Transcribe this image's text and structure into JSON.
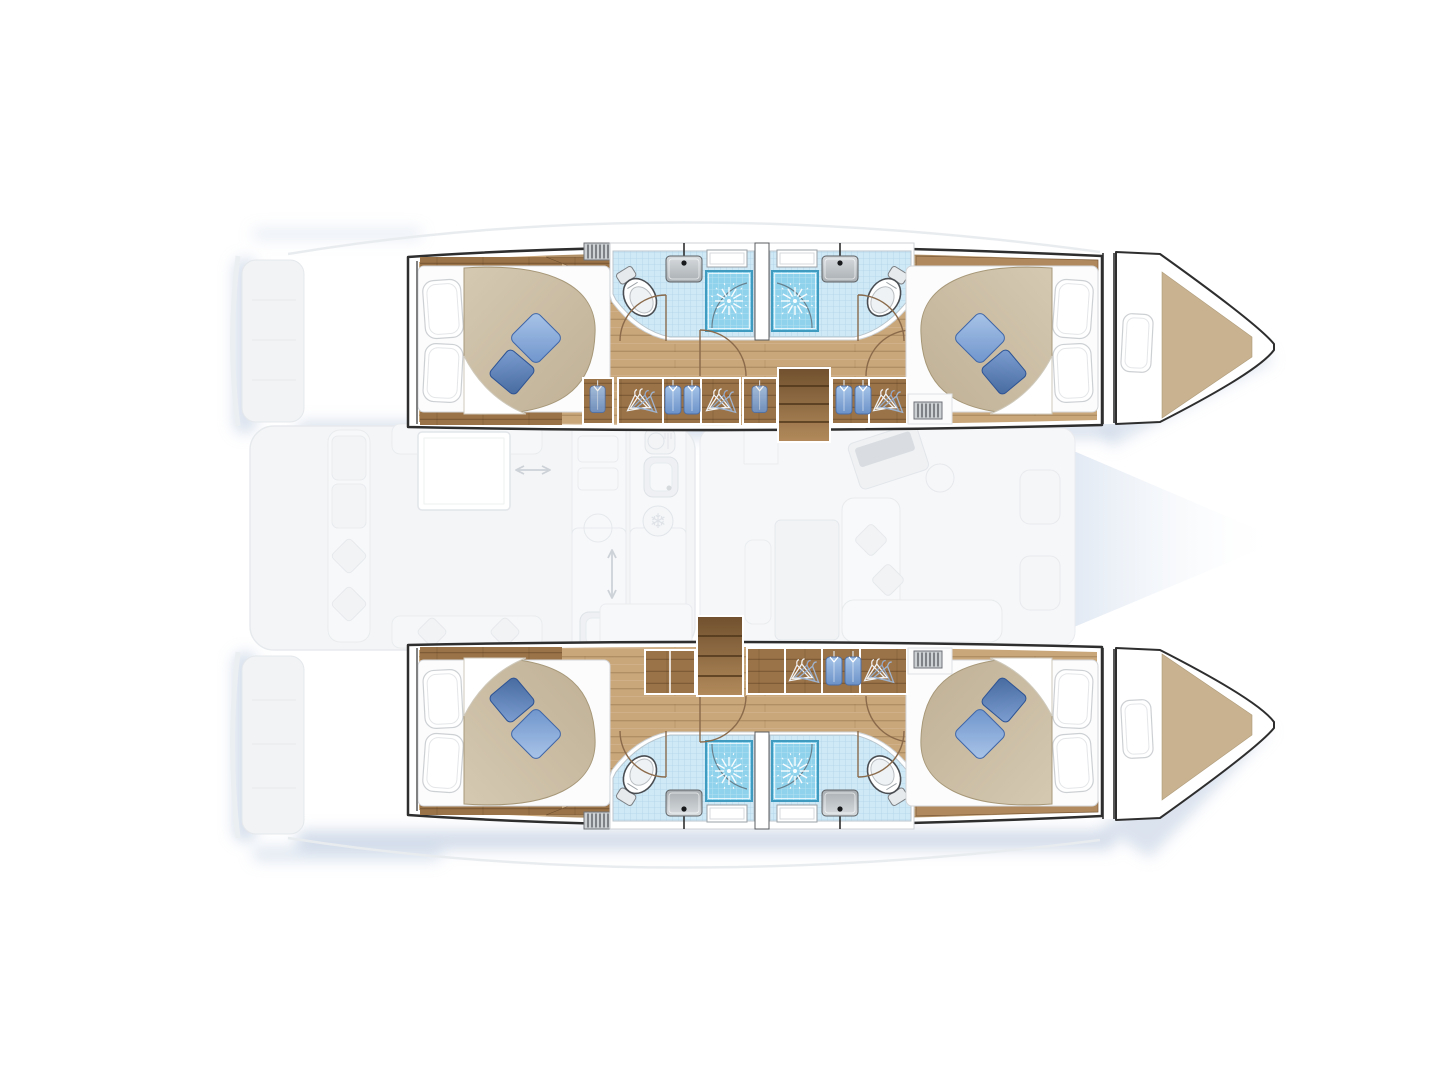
{
  "diagram": {
    "kind": "catamaran-yacht-deck-layout-plan",
    "view": "overhead floor plan",
    "highlighted_areas": "hull interiors: cabins, corridors, bathrooms, wardrobes, companionway steps",
    "faded_areas": "swim platforms, cockpit, galley, salon, foredeck",
    "counts": {
      "hulls": 2,
      "double_cabins": 4,
      "bathrooms": 4,
      "showers": 4,
      "toilets": 4,
      "sinks": 4,
      "forepeak_berths": 2,
      "companionway_steps": 2,
      "wardrobes": 6,
      "vent_grates": 4,
      "deck_hatches": 4
    }
  },
  "palette": {
    "hull_stroke": "#2e2e2e",
    "wood_base": "#c9a77b",
    "wood_dark": "#9b7348",
    "trim": "#b08a5e",
    "tile_base": "#cfe9f7",
    "shower_base": "#8fd2ec",
    "shower_edge": "#3f9cc0",
    "duvet_1": "#d5c9b2",
    "duvet_2": "#bfb095",
    "cushion_light": "#89a9d6",
    "cushion_dark": "#5477b5",
    "door": "#8a6a4a",
    "shadow": "#b7c7de",
    "faded_fill": "#f4f5f7",
    "faded_stroke": "#e7eaed",
    "background": "#ffffff"
  },
  "hulls": [
    {
      "name": "upper hull",
      "aft_cabin": {
        "bed": "double bed, headboard aft",
        "pillows_white": 2,
        "cushions_blue": 2
      },
      "forward_cabin": {
        "bed": "double bed, headboard forward",
        "pillows_white": 2,
        "cushions_blue": 2
      },
      "bathrooms": [
        {
          "fixtures": [
            "toilet",
            "sink",
            "shower stall",
            "deck hatch"
          ]
        },
        {
          "fixtures": [
            "toilet",
            "sink",
            "shower stall",
            "deck hatch"
          ]
        }
      ],
      "wardrobes": [
        "hanging locker",
        "wardrobe: hangers + shirts + hangers",
        "hanging locker",
        "wardrobe: shirts + hangers"
      ],
      "steps": "companionway from salon",
      "bow": "forepeak berth with pillow"
    },
    {
      "name": "lower hull",
      "aft_cabin": {
        "bed": "double bed, headboard aft",
        "pillows_white": 2,
        "cushions_blue": 2
      },
      "forward_cabin": {
        "bed": "double bed, headboard forward",
        "pillows_white": 2,
        "cushions_blue": 2
      },
      "bathrooms": [
        {
          "fixtures": [
            "toilet",
            "sink",
            "shower stall",
            "deck hatch"
          ]
        },
        {
          "fixtures": [
            "toilet",
            "sink",
            "shower stall",
            "deck hatch"
          ]
        }
      ],
      "wardrobes": [
        "locker",
        "wardrobe: hangers + shirts + hangers"
      ],
      "steps": "companionway from salon",
      "bow": "forepeak berth with pillow"
    }
  ],
  "salon_faded": {
    "features": [
      "swim platforms",
      "cockpit bench seating",
      "cockpit table",
      "galley sink",
      "stove",
      "refrigerator snowflake icon",
      "dish locker icon",
      "sliding-door arrows",
      "salon table",
      "bench",
      "L-sofa with cushions",
      "nav desk",
      "foredeck seats"
    ]
  }
}
